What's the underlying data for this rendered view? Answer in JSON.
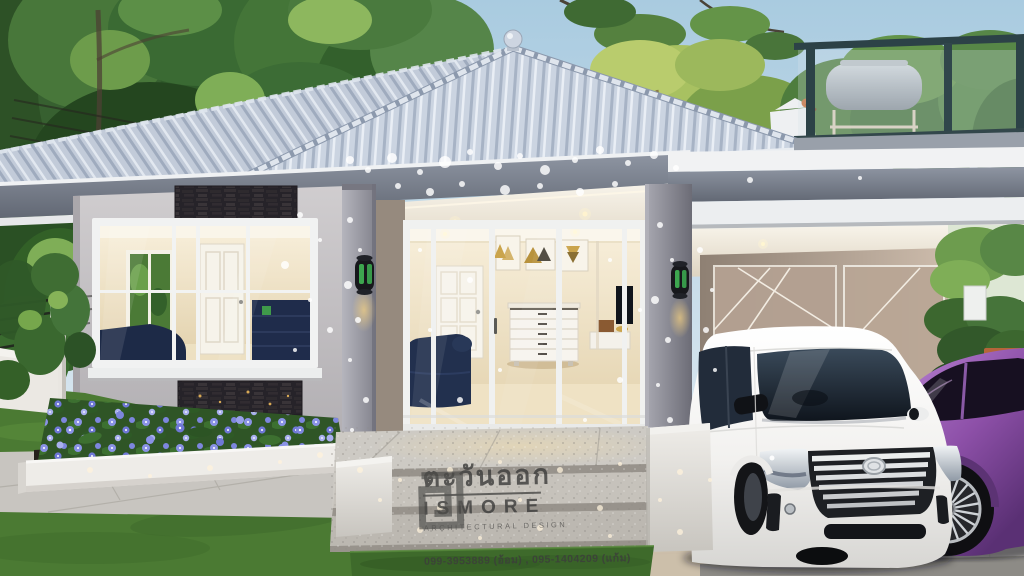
{
  "image": {
    "kind": "photorealistic 3D architectural rendering",
    "caption": "Modern single-storey grey house at dusk with warm-lit glass entrance, rooftop deck with barbecue grill, carport sheltering a white minivan and a purple sedan, stone steps, blue flower bed, lawn and fence in the front yard"
  },
  "watermark": {
    "thai_title": "ตะวันออก",
    "brand": "ISMORE",
    "tagline": "ARCHITECTURAL DESIGN",
    "contacts": "099-3953889 (อ้อม) , 095-1404209 (แก้ม)"
  },
  "scene": {
    "objects": [
      "hip roof with ball finial",
      "rooftop deck railing",
      "bbq grill",
      "perched bird",
      "left wing picture window",
      "dark stone accent panels",
      "entrance sliding glass doors",
      "interior framed triangle art (3)",
      "white dresser",
      "navy sofa",
      "white panel door",
      "porch pillars with green glass wall lamps",
      "granite entrance steps",
      "white minivan",
      "purple sedan",
      "carport with decorative glass panels",
      "blue flower planter",
      "lawn",
      "black rail fence",
      "paver walkway",
      "trees"
    ],
    "lighting": "dusk, warm interior glow, dappled sunlight speckles"
  },
  "colors": {
    "sky_top": "#aecfe3",
    "sky_horizon": "#e8f0f5",
    "roof_tile": "#c9d3e0",
    "fascia_grey": "#79808d",
    "wall_grey": "#c6c3c6",
    "stone_accent": "#282428",
    "trim_white": "#f0f1f2",
    "interior_glow": "#f4e7c8",
    "lamp_glass_green": "#3fae52",
    "lawn_green": "#4b7a33",
    "flower_violet": "#8a92e6",
    "planter_white": "#eeece8",
    "steps_granite": "#b5b1ac",
    "minivan_white": "#f7f6f4",
    "sedan_purple": "#8d50a8",
    "railing_teal": "#2c4247",
    "watermark_text": "#3d3d3c"
  }
}
